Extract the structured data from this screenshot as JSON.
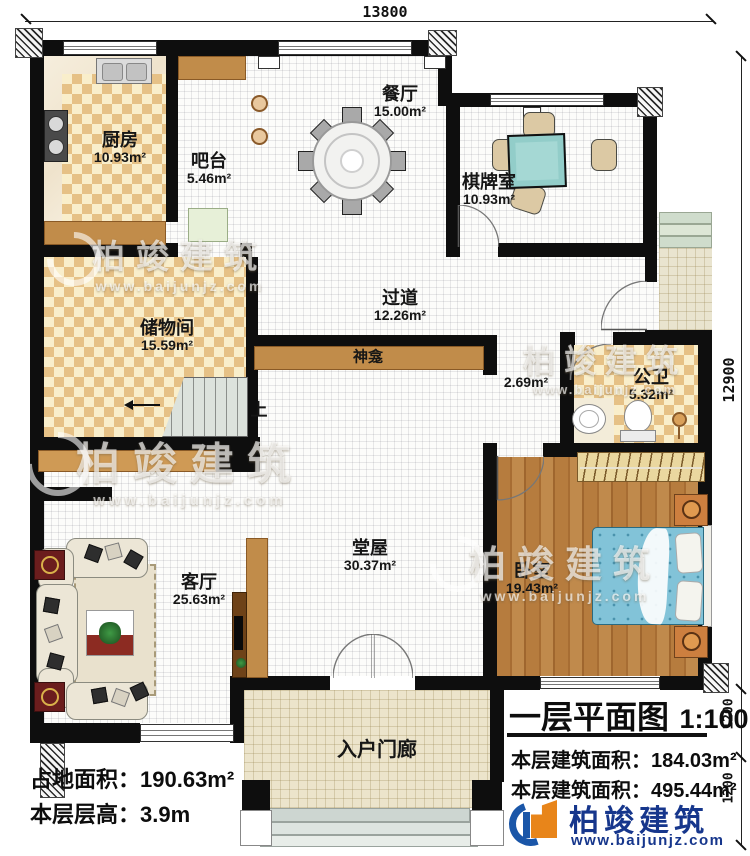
{
  "dimensions": {
    "top": "13800",
    "right_main": "12900",
    "right_lower_1": "1200",
    "right_lower_2": "1200"
  },
  "rooms": {
    "kitchen": {
      "name": "厨房",
      "area": "10.93m²"
    },
    "bar": {
      "name": "吧台",
      "area": "5.46m²"
    },
    "dining": {
      "name": "餐厅",
      "area": "15.00m²"
    },
    "mahjong": {
      "name": "棋牌室",
      "area": "10.93m²"
    },
    "storage": {
      "name": "储物间",
      "area": "15.59m²"
    },
    "corridor": {
      "name": "过道",
      "area": "12.26m²"
    },
    "shrine": {
      "name": "神龛"
    },
    "niche": {
      "area": "2.69m²"
    },
    "bathroom": {
      "name": "公卫",
      "area": "5.32m²"
    },
    "living": {
      "name": "客厅",
      "area": "25.63m²"
    },
    "hall": {
      "name": "堂屋",
      "area": "30.37m²"
    },
    "bedroom": {
      "name": "卧室",
      "area": "19.43m²"
    },
    "porch": {
      "name": "入户门廊"
    },
    "stairs": {
      "up": "上"
    }
  },
  "site_info": {
    "plot_area_label": "占地面积：",
    "plot_area_value": "190.63m²",
    "floor_height_label": "本层层高：",
    "floor_height_value": "3.9m"
  },
  "title_block": {
    "title": "一层平面图",
    "scale": "1:100",
    "area_label_1": "本层建筑面积：",
    "area_value_1": "184.03m²",
    "area_label_2": "本层建筑面积：",
    "area_value_2": "495.44m²"
  },
  "brand": {
    "name": "柏竣建筑",
    "url": "www.baijunjz.com"
  },
  "colors": {
    "wall": "#0e0e0e",
    "wood_counter": "#c18c4a",
    "checker_tan": "#e6c186",
    "mattress_blue": "#82c3d8",
    "mahjong_teal": "#92cdc9",
    "brand_blue": "#16368c",
    "brand_orange": "#e8851a"
  }
}
